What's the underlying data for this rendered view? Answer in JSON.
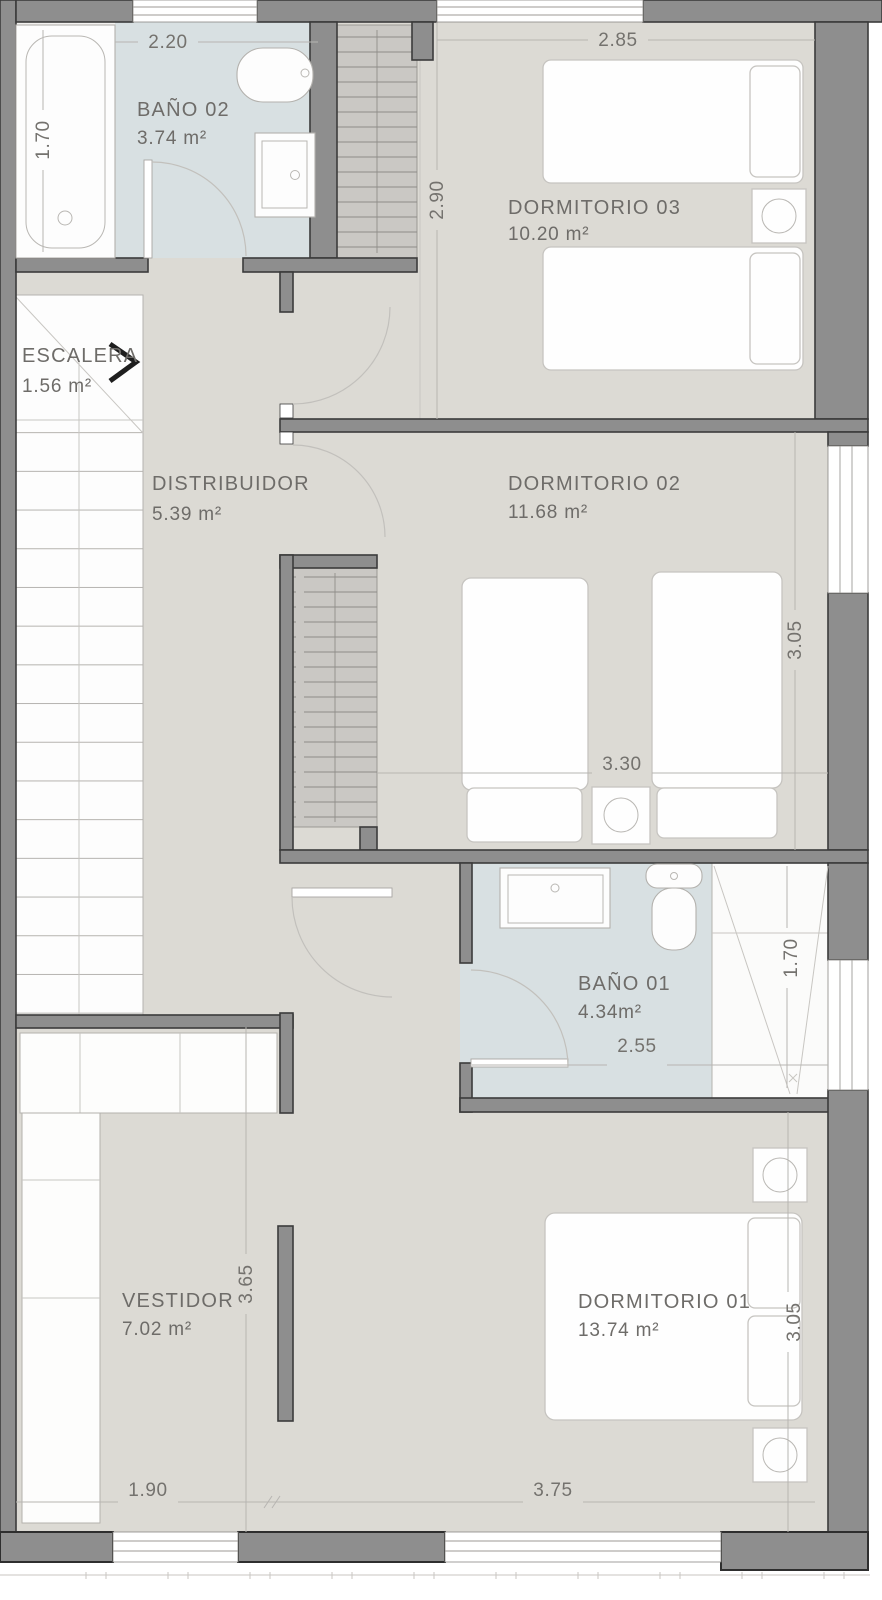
{
  "plan_type": "floor-plan",
  "rooms": {
    "bano02": {
      "name": "BAÑO 02",
      "area": "3.74 m²"
    },
    "dormitorio03": {
      "name": "DORMITORIO 03",
      "area": "10.20 m²"
    },
    "escalera": {
      "name": "ESCALERA",
      "area": "1.56  m²"
    },
    "distribuidor": {
      "name": "DISTRIBUIDOR",
      "area": "5.39 m²"
    },
    "dormitorio02": {
      "name": "DORMITORIO 02",
      "area": "11.68 m²"
    },
    "bano01": {
      "name": "BAÑO 01",
      "area": "4.34m²"
    },
    "vestidor": {
      "name": "VESTIDOR",
      "area": "7.02 m²"
    },
    "dormitorio01": {
      "name": "DORMITORIO 01",
      "area": "13.74 m²"
    }
  },
  "dimensions": {
    "bano02_width": "2.20",
    "bathtub_length": "1.70",
    "dormitorio03_width": "2.85",
    "dormitorio03_depth": "2.90",
    "dormitorio02_depth": "3.05",
    "dormitorio02_bed_span": "3.30",
    "bano01_shower_depth": "1.70",
    "bano01_width": "2.55",
    "vestidor_depth": "3.65",
    "dormitorio01_depth": "3.05",
    "vestidor_width": "1.90",
    "dormitorio01_width": "3.75"
  },
  "colors": {
    "wall": "#8e8e8e",
    "wall_outline": "#3b3b3b",
    "floor": "#dcdad4",
    "bathroom_floor": "#d8e0e2",
    "closet_fill": "#cac8c4",
    "label_text": "#6e6c69"
  }
}
